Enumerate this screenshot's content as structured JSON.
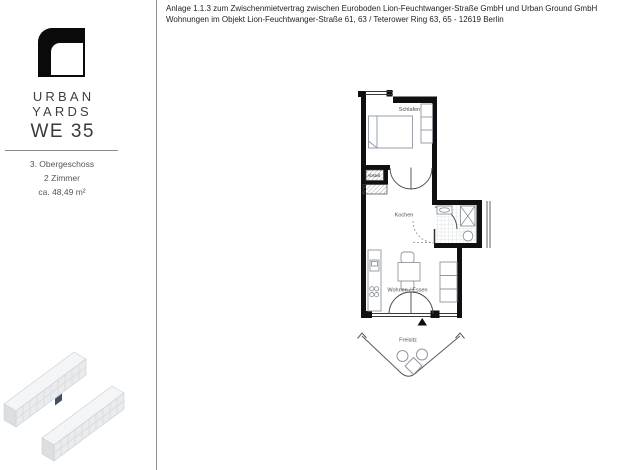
{
  "document": {
    "header_line1": "Anlage 1.1.3 zum Zwischenmietvertrag zwischen Euroboden Lion-Feuchtwanger-Straße GmbH und Urban Ground GmbH",
    "header_line2": "Wohnungen im Objekt Lion-Feuchtwanger-Straße 61, 63 / Teterower Ring 63, 65 - 12619 Berlin"
  },
  "sidebar": {
    "brand": "URBAN YARDS",
    "unit": "WE 35",
    "floor": "3. Obergeschoss",
    "rooms": "2 Zimmer",
    "area": "ca. 48,49 m²"
  },
  "floorplan": {
    "labels": {
      "bedroom": "Schlafen",
      "storage": "Abstell.",
      "kitchen": "Kochen",
      "living": "Wohnen / Essen",
      "terrace": "Freisitz"
    }
  },
  "colors": {
    "wall": "#101010",
    "highlight_unit": "#3f5062",
    "divider": "#8f8f8f"
  }
}
